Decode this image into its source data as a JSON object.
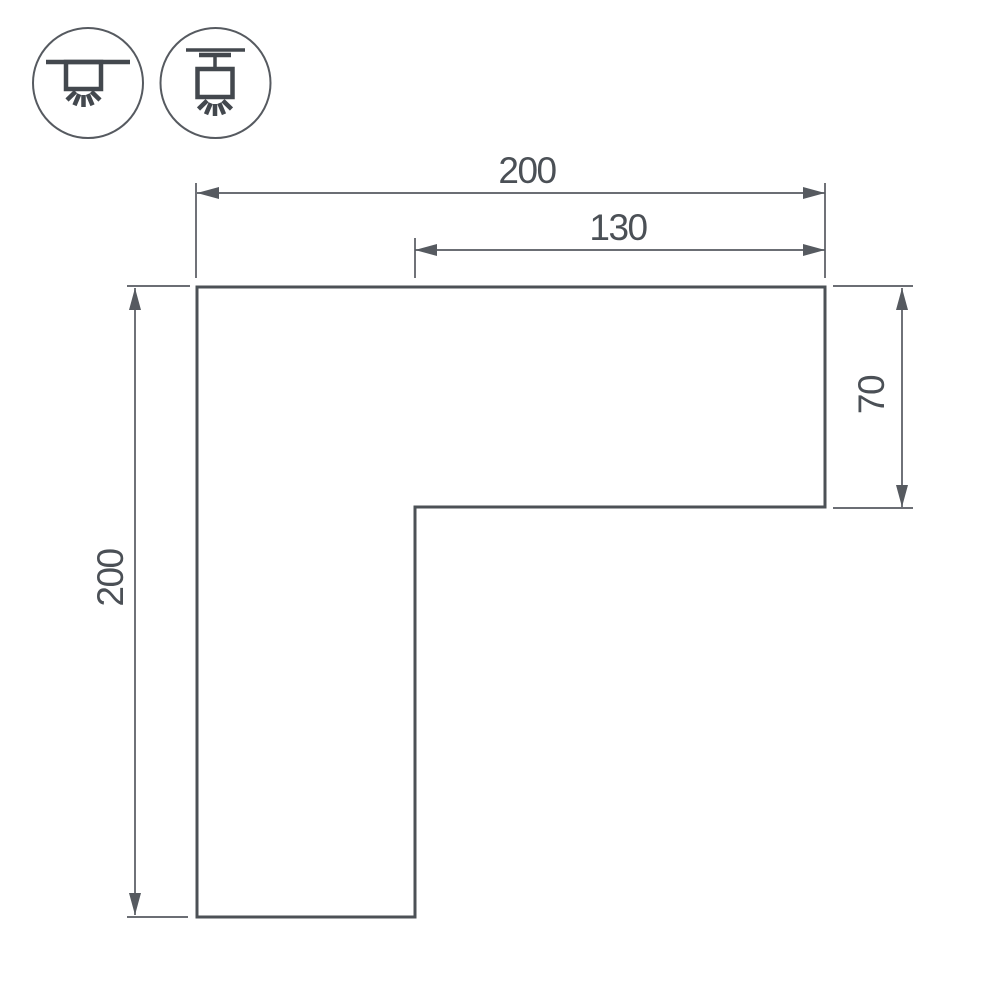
{
  "colors": {
    "line": "#565a60",
    "outline": "#4c5156",
    "icon": "#43484e",
    "text": "#4b5056",
    "background": "#ffffff"
  },
  "dimensions": {
    "top_width": "200",
    "top_inner_width": "130",
    "left_height": "200",
    "right_height": "70"
  },
  "icons": [
    {
      "name": "recessed-ceiling-mount-icon"
    },
    {
      "name": "surface-ceiling-mount-icon"
    }
  ]
}
